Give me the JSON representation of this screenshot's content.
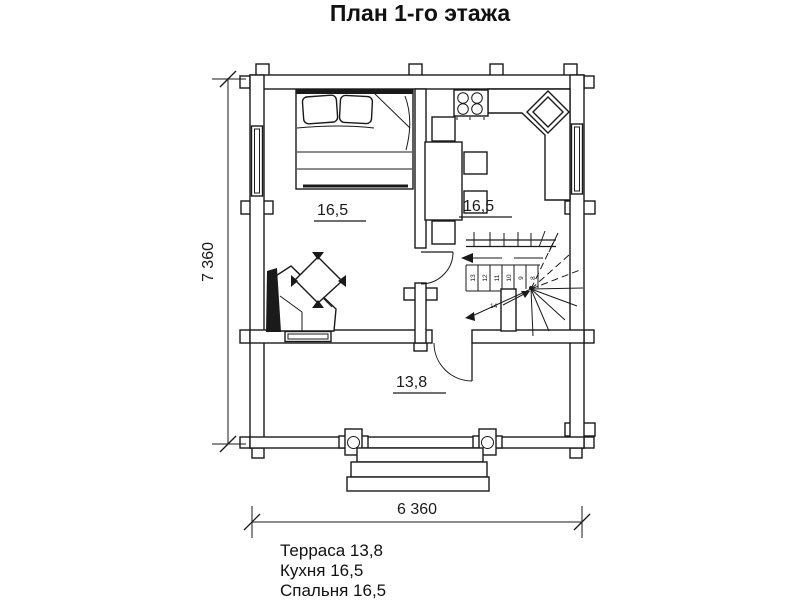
{
  "title": "План 1-го этажа",
  "plan": {
    "room_labels": {
      "bedroom_area": "16,5",
      "kitchen_area": "16,5",
      "terrace_area": "13,8"
    },
    "dimensions": {
      "height_label": "7 360",
      "width_label": "6 360"
    },
    "stairs": {
      "step_numbers": [
        "13",
        "12",
        "11",
        "10",
        "9",
        "8"
      ],
      "flight_label": "14"
    }
  },
  "legend": {
    "items": [
      "Терраса 13,8",
      "Кухня 16,5",
      "Спальня 16,5"
    ]
  },
  "colors": {
    "ink": "#1a1a1a",
    "background": "#ffffff"
  }
}
